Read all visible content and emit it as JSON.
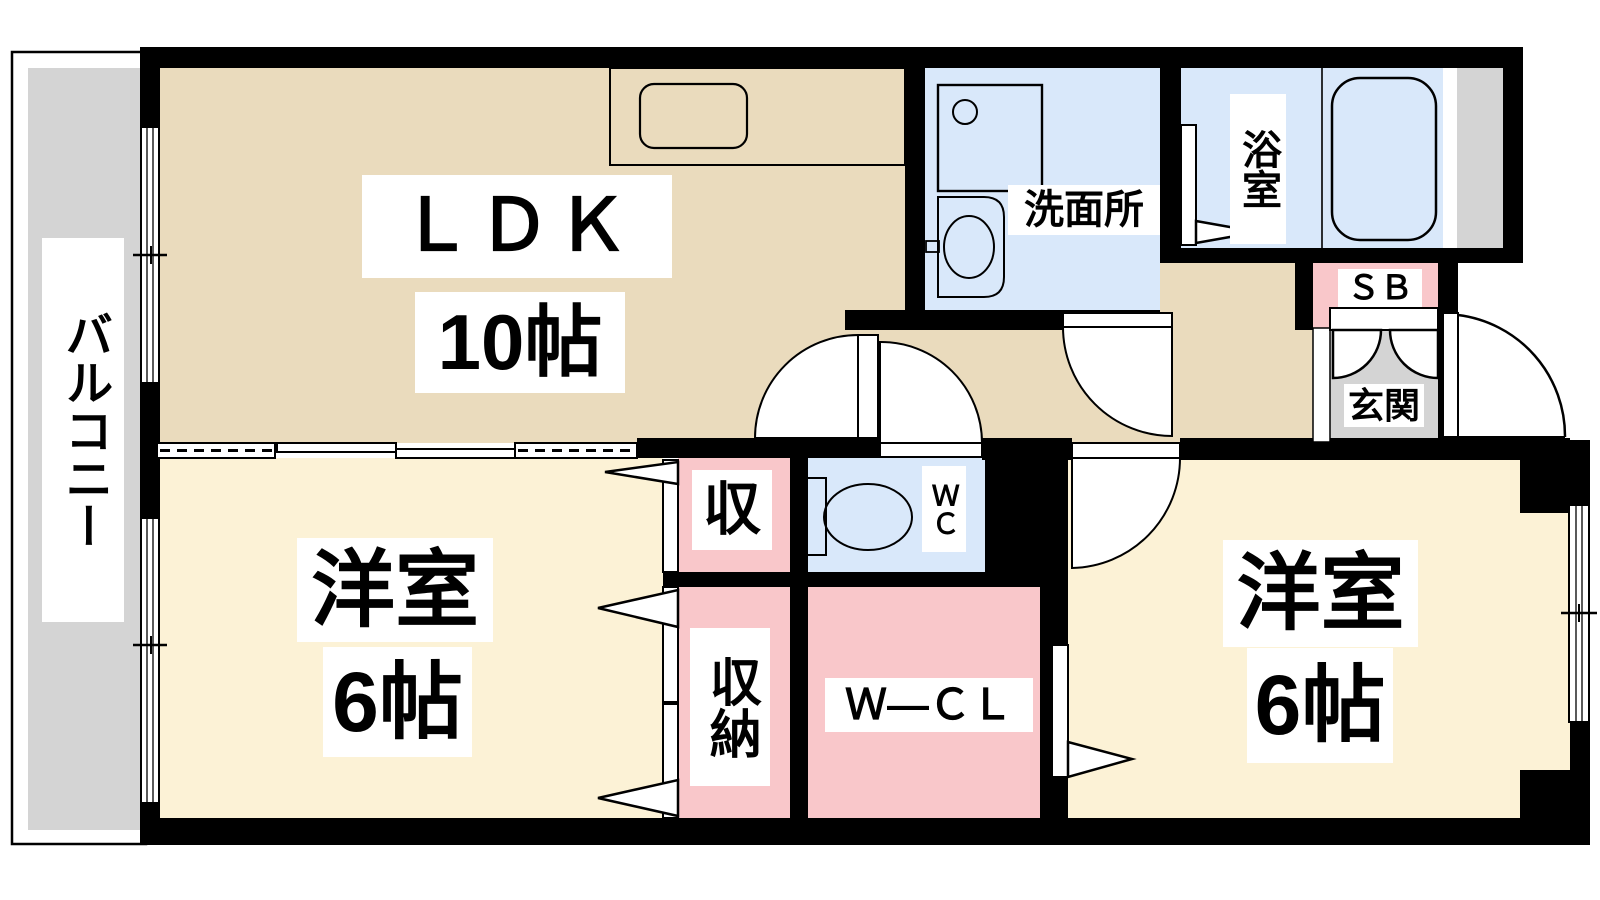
{
  "floorplan": {
    "balcony": {
      "label": "バルコニー"
    },
    "ldk": {
      "label": "ＬＤＫ",
      "size": "10帖"
    },
    "washroom": {
      "label": "洗面所"
    },
    "bathroom": {
      "label": "浴室"
    },
    "shoebox": {
      "label": "ＳＢ"
    },
    "entrance": {
      "label": "玄関"
    },
    "wc": {
      "label": "ＷＣ"
    },
    "closet_upper": {
      "label": "収"
    },
    "closet_lower": {
      "label": "収納"
    },
    "walk_in_closet": {
      "label": "Ｗ―ＣＬ"
    },
    "bedroom_left": {
      "label": "洋室",
      "size": "6帖"
    },
    "bedroom_right": {
      "label": "洋室",
      "size": "6帖"
    }
  },
  "colors": {
    "wall": "#000000",
    "beige": "#EADBBD",
    "cream": "#FCF2D6",
    "wet": "#D9E8FA",
    "pink": "#F9C7CA",
    "gray": "#D4D4D4",
    "white": "#FFFFFF"
  }
}
